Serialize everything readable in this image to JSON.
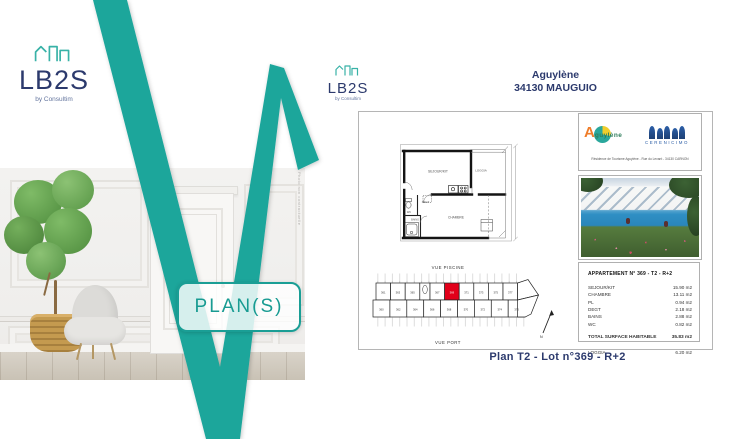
{
  "brand": {
    "wordmark": "LB2S",
    "byline": "by Consultim"
  },
  "left_panel": {
    "plans_label": "PLAN(S)",
    "photo_credit": "Photo non contractuelle"
  },
  "doc": {
    "title1": "Aguylène",
    "title2": "34130 MAUGUIO",
    "floorplan_labels": {
      "sejour": "SEJOUR/KIT",
      "loggia": "LOGGIA",
      "degt": "DEGT",
      "chambre": "CHAMBRE",
      "wc": "WC",
      "bains": "BAINS"
    },
    "partners": {
      "aguylene_initial": "A",
      "aguylene_rest": "guylène",
      "cerenicimo": "CERENICIMO",
      "address": "Résidence de Tourisme Aguylène - Rue du Levant - 34130 CARNON"
    },
    "details": {
      "header": "APPARTEMENT N° 369 - T2 - R+2",
      "rows": [
        {
          "label": "SEJOUR/KIT",
          "value": "15.90 m2"
        },
        {
          "label": "CHAMBRE",
          "value": "13.11 m2"
        },
        {
          "label": "PL",
          "value": "0.94 m2"
        },
        {
          "label": "DEGT",
          "value": "2.18 m2"
        },
        {
          "label": "BAINS",
          "value": "2.88 m2"
        },
        {
          "label": "WC",
          "value": "0.82 m2"
        }
      ],
      "total_label": "TOTAL SURFACE HABITABLE",
      "total_value": "35.83 m2",
      "loggia_label": "LOGGIA",
      "loggia_value": "6.20 m2"
    },
    "keyplan": {
      "vue_piscine": "VUE PISCINE",
      "vue_port": "VUE PORT",
      "north": "N",
      "highlighted_unit": "369",
      "top_units": [
        "361",
        "363",
        "365",
        "367",
        "369",
        "371",
        "373",
        "375",
        "377"
      ],
      "bottom_units": [
        "360",
        "362",
        "364",
        "366",
        "368",
        "370",
        "372",
        "374",
        "376"
      ]
    },
    "caption": "Plan T2  - Lot n°369 - R+2"
  },
  "colors": {
    "teal": "#1ba69b",
    "navy": "#2c3a6d",
    "red": "#e2001a"
  }
}
